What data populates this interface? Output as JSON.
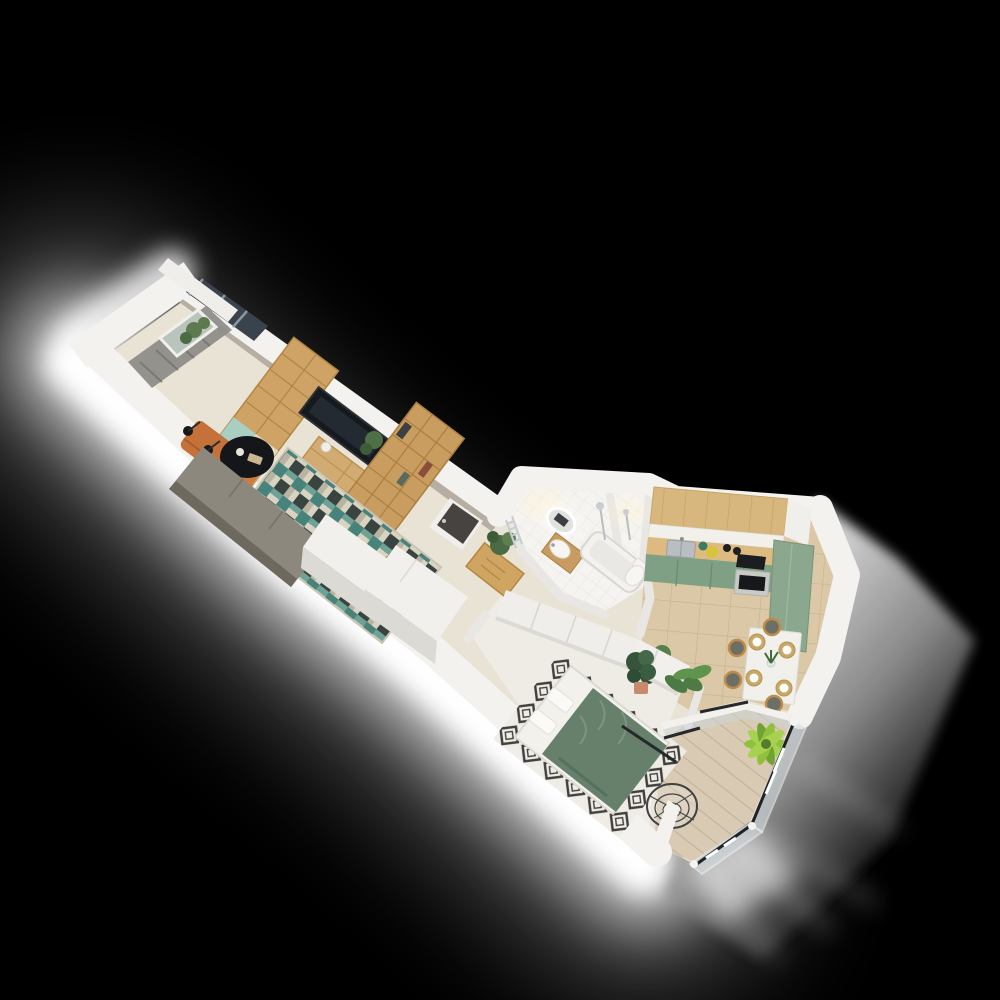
{
  "scene": {
    "kind": "isometric-3d-floor-plan-render",
    "background": "black",
    "lighting": [
      "bright-glow-along-lower-left-wall",
      "soft-gray-light-wedge-right-side",
      "light-rays-below-balcony"
    ]
  },
  "palette": {
    "background": "#000000",
    "glow": "#ffffff",
    "wall_top": "#f3f2ef",
    "wall_side": "#dcdad5",
    "wall_inner": "#b6aea3",
    "floor_base": "#e9e3d6",
    "floor_bath": "#f5f4f1",
    "floor_bed": "#efece6",
    "floor_tile": "#dbc8a7",
    "deck": "#d8cab3",
    "oak": "#cfa265",
    "oak_dark": "#b3873f",
    "console_wood": "#d2ab72",
    "tv_black": "#16191d",
    "sofa": "#8d887e",
    "sofa_back": "#6e695f",
    "armchair_orange": "#c4713a",
    "rug_teal": "#47837b",
    "rug_dark": "#394440",
    "rug_cream": "#d9d3c2",
    "curtain_gray": "#8f8d89",
    "window_glass_dark": "#3a434d",
    "kitchen_wood": "#d8b77e",
    "counter_wood": "#dcba80",
    "cabinet_green": "#7fa085",
    "cabinet_green_tall": "#8ba78d",
    "appliance_dark": "#1b1d21",
    "duvet_green": "#66806c",
    "duvet_fold": "#7d947f",
    "plant_green": "#4c6b44",
    "plant_dark": "#35543a",
    "palm_bright": "#8fc13c",
    "pot_terracotta": "#c98a6b",
    "chrome": "#c9ccd0",
    "glass_pane": "#ccd6da",
    "rail_dark": "#26282b",
    "placemat": "#c8a96a"
  },
  "rooms": [
    {
      "id": "living-room",
      "furniture": [
        "balcony-window",
        "curtains",
        "bookcase-teal-drawers",
        "tv",
        "tv-console",
        "shelving-unit",
        "sofa",
        "armchair",
        "ottoman",
        "floor-lamps",
        "coffee-table",
        "patterned-rug",
        "side-chair"
      ]
    },
    {
      "id": "hallway",
      "furniture": [
        "entrance-door",
        "white-wardrobe-blocks",
        "chest-of-drawers",
        "potted-plant"
      ]
    },
    {
      "id": "bathroom",
      "furniture": [
        "led-mirror",
        "vanity-sink",
        "bathtub",
        "shower-set",
        "towel-radiator",
        "toilet"
      ]
    },
    {
      "id": "kitchen",
      "furniture": [
        "tall-wood-cabinets",
        "backsplash",
        "countertop",
        "sink",
        "cooktop",
        "oven",
        "green-base-cabinets",
        "green-tall-cabinet",
        "dining-table",
        "chairs",
        "placemats",
        "floor-plants"
      ]
    },
    {
      "id": "bedroom",
      "furniture": [
        "wardrobe",
        "double-bed",
        "pillows",
        "diamond-rug",
        "potted-plants"
      ]
    },
    {
      "id": "balcony",
      "furniture": [
        "hanging-chair",
        "palm-plant",
        "glass-railing",
        "wood-decking"
      ]
    }
  ]
}
